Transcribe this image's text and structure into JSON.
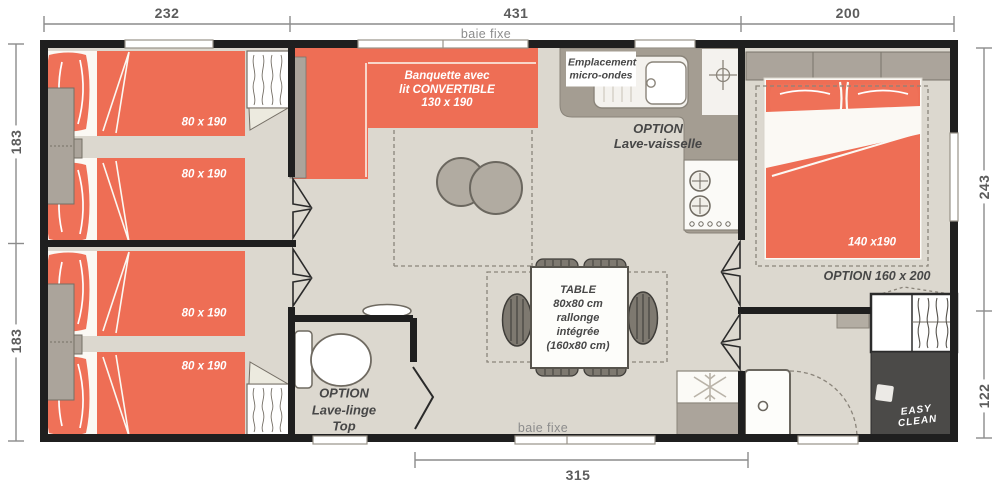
{
  "plan_title": "mobile-home floor plan",
  "colors": {
    "bed_orange": "#ee6e55",
    "pillow_orange": "#ef7158",
    "floor": "#dcd8cf",
    "wall_black": "#1f1f1f",
    "counter_taupe": "#a49d92",
    "furniture_gray": "#aba49b",
    "shower_dark": "#4b4a48",
    "dim_text_gray": "#5c5c5c",
    "label_gray": "#474747",
    "window_label_gray": "#8c8c8c"
  },
  "dimensions": {
    "top": [
      "232",
      "431",
      "200"
    ],
    "left": [
      "183",
      "183"
    ],
    "right": [
      "243",
      "122"
    ],
    "bottom": [
      "315"
    ]
  },
  "windows": {
    "top_label": "baie fixe",
    "bottom_label": "baie fixe"
  },
  "bedroom1": {
    "bed1_size": "80 x 190",
    "bed2_size": "80 x 190"
  },
  "bedroom2": {
    "bed1_size": "80 x 190",
    "bed2_size": "80 x 190"
  },
  "master_bedroom": {
    "bed_size": "140 x190",
    "bed_option": "OPTION 160 x 200"
  },
  "living": {
    "banquette_line1": "Banquette avec",
    "banquette_line2": "lit CONVERTIBLE",
    "banquette_line3": "130 x 190",
    "table_line1": "TABLE",
    "table_line2": "80x80 cm",
    "table_line3": "rallonge",
    "table_line4": "intégrée",
    "table_line5": "(160x80 cm)"
  },
  "kitchen": {
    "microwave_line1": "Emplacement",
    "microwave_line2": "micro-ondes",
    "dishwasher_line1": "OPTION",
    "dishwasher_line2": "Lave-vaisselle"
  },
  "wc": {
    "option_line1": "OPTION",
    "option_line2": "Lave-linge",
    "option_line3": "Top"
  },
  "logo": {
    "line1": "EASY",
    "line2": "CLEAN"
  }
}
